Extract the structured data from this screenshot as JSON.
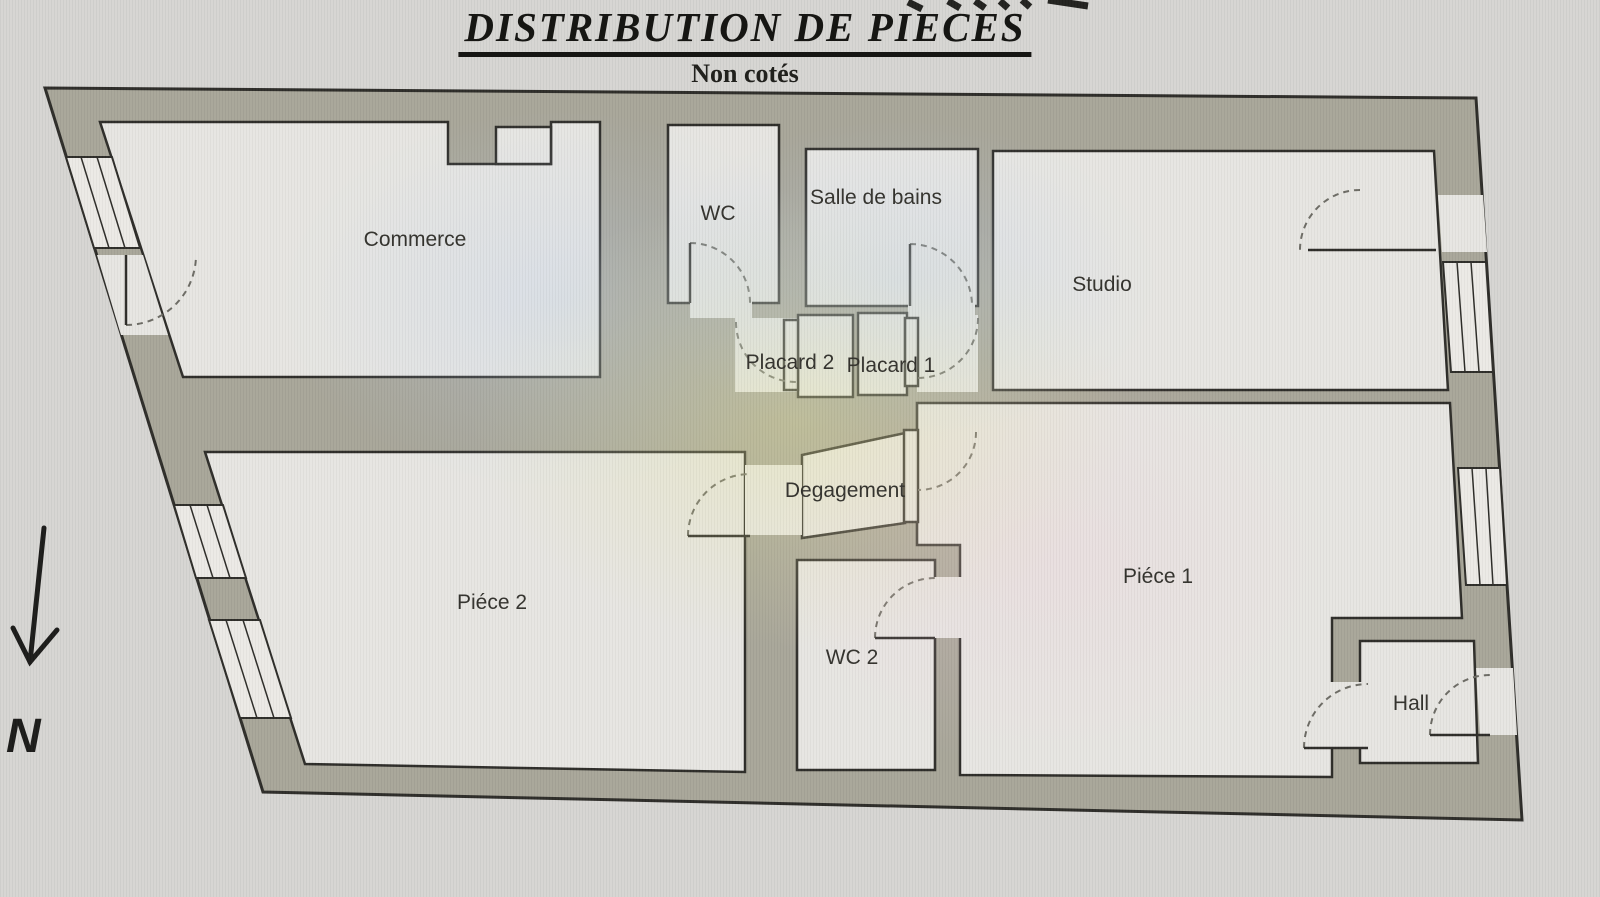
{
  "header": {
    "title": "DISTRIBUTION DE PIECES",
    "subtitle": "Non cotés"
  },
  "compass": {
    "label": "N"
  },
  "rooms": {
    "commerce": {
      "label": "Commerce"
    },
    "wc": {
      "label": "WC"
    },
    "salle_de_bains": {
      "label": "Salle de bains"
    },
    "studio": {
      "label": "Studio"
    },
    "placard_2": {
      "label": "Placard 2"
    },
    "placard_1": {
      "label": "Placard 1"
    },
    "degagement": {
      "label": "Degagement"
    },
    "piece_2": {
      "label": "Piéce 2"
    },
    "wc_2": {
      "label": "WC 2"
    },
    "piece_1": {
      "label": "Piéce 1"
    },
    "hall": {
      "label": "Hall"
    }
  },
  "colors": {
    "background": "#d6d5d2",
    "wall": "#a8a699",
    "room": "#e7e6e2",
    "line": "#2e2d29",
    "door_arc": "#6d6c65",
    "text": "#34332e"
  }
}
